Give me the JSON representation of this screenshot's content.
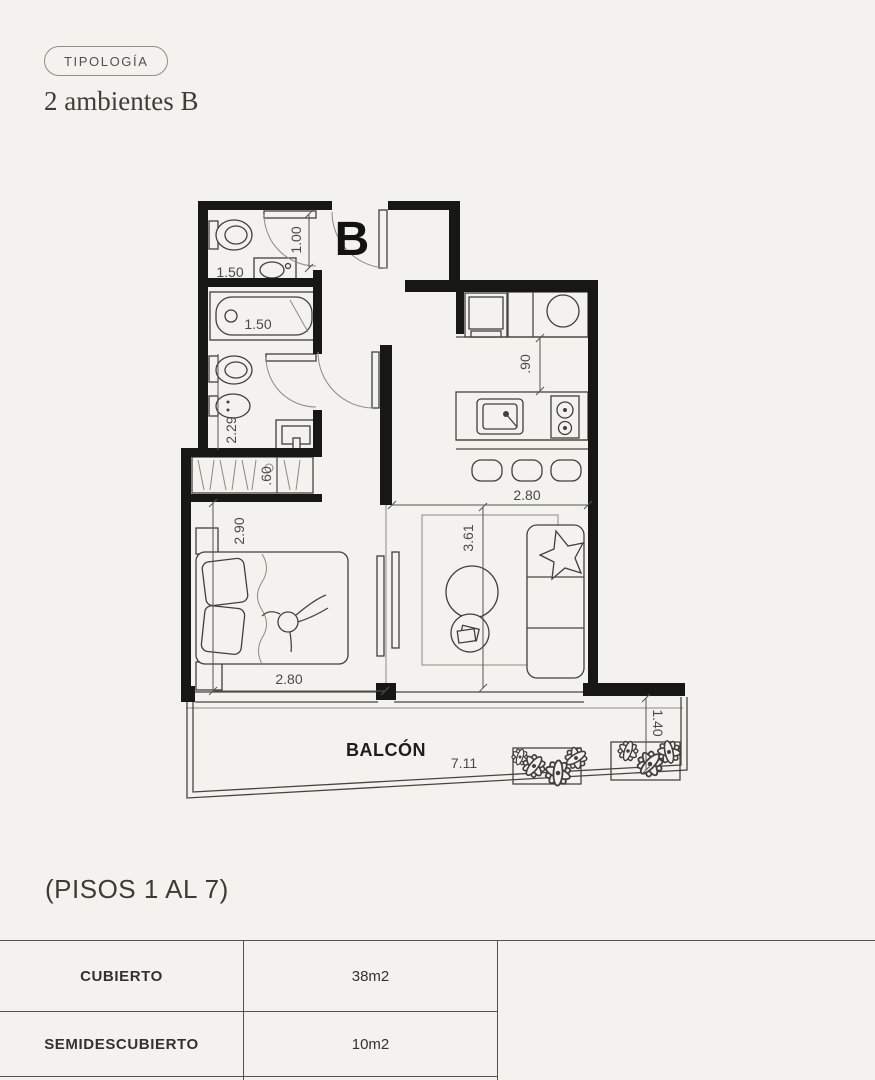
{
  "header": {
    "badge": "TIPOLOGÍA",
    "title": "2 ambientes B"
  },
  "plan": {
    "unit_label": "B",
    "balcony_label": "BALCÓN",
    "dims": {
      "entry_door": "1.00",
      "bath1_width": "1.50",
      "bath2_width": "1.50",
      "bath3_depth": "2.29",
      "closet_depth": ".60",
      "kitchen_counter": ".90",
      "kitchen_width": "2.80",
      "bedroom_depth": "2.90",
      "bedroom_width": "2.80",
      "living_depth": "3.61",
      "balcony_width": "7.11",
      "balcony_depth": "1.40"
    }
  },
  "footer": {
    "floors_note": "(PISOS 1 AL 7)",
    "areas": {
      "rows": [
        {
          "label": "CUBIERTO",
          "value": "38m2"
        },
        {
          "label": "SEMIDESCUBIERTO",
          "value": "10m2"
        }
      ]
    }
  },
  "colors": {
    "background": "#f4f2ee",
    "wall": "#171715",
    "line": "#46463f",
    "text": "#3a3a34"
  }
}
